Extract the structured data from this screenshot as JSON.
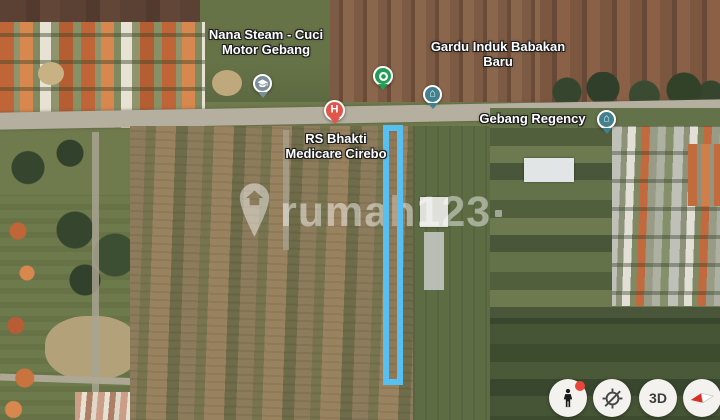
{
  "colors": {
    "highlight_blue": "#55c0f1",
    "hospital_red": "#e0564b",
    "marker_teal": "#41808f",
    "marker_gray": "#7b8e9a",
    "pin_green": "#219e54",
    "control_bg": "#f4f2ef"
  },
  "pois": {
    "nana_steam": {
      "label": "Nana Steam - Cuci Motor Gebang"
    },
    "gardu_induk": {
      "label": "Gardu Induk Babakan Baru"
    },
    "rs_bhakti": {
      "label": "RS Bhakti Medicare Cirebo",
      "marker_letter": "H"
    },
    "gebang_regency": {
      "label": "Gebang Regency"
    }
  },
  "icons": {
    "housing_glyph": "⌂"
  },
  "watermark": {
    "text": "rumah123"
  },
  "controls": {
    "threed_label": "3D"
  }
}
